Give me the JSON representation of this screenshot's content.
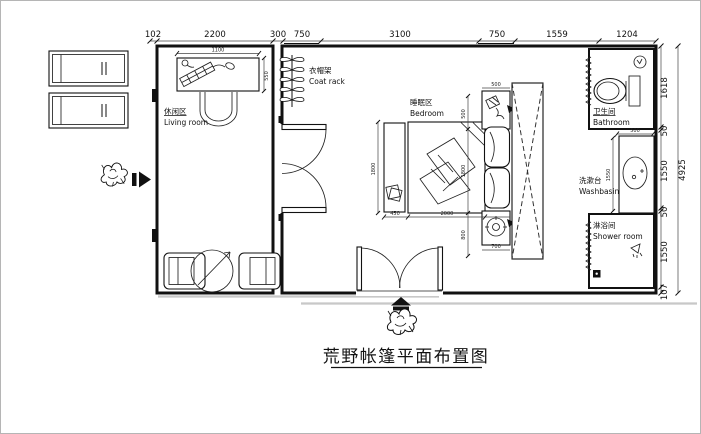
{
  "title": {
    "text": "荒野帐篷平面布置图"
  },
  "rooms": {
    "living": {
      "zh": "休闲区",
      "en": "Living room"
    },
    "coatrack": {
      "zh": "衣帽架",
      "en": "Coat rack"
    },
    "bedroom": {
      "zh": "睡眠区",
      "en": "Bedroom"
    },
    "bathroom": {
      "zh": "卫生间",
      "en": "Bathroom"
    },
    "washbasin": {
      "zh": "洗漱台",
      "en": "Washbasin"
    },
    "shower": {
      "zh": "淋浴间",
      "en": "Shower room"
    }
  },
  "dims": {
    "top": [
      "102",
      "2200",
      "300",
      "750",
      "3100",
      "750",
      "1559",
      "1204"
    ],
    "right": [
      "1618",
      "50",
      "1550",
      "50",
      "1550",
      "107"
    ],
    "right_total": "4925",
    "interior": {
      "desk_width": "1100",
      "desk_depth": "550",
      "bench_width": "450",
      "bed_length": "2000",
      "bed_width": "1800",
      "head_shelf": "500",
      "foot_gap": "800",
      "lamp_table": "700",
      "counter_width": "500",
      "basin_length": "1550"
    }
  },
  "colors": {
    "line": "#111111",
    "dimension": "#444444",
    "ground": "#c8c8c8"
  }
}
